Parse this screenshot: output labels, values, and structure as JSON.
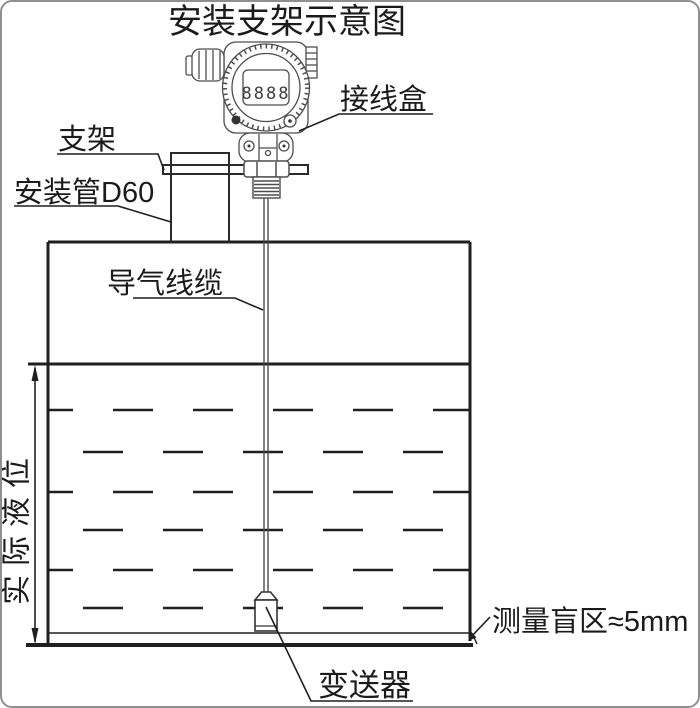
{
  "title": "安装支架示意图",
  "labels": {
    "junction_box": "接线盒",
    "bracket": "支架",
    "mounting_pipe": "安装管D60",
    "air_cable": "导气线缆",
    "actual_level": "实际液位",
    "blind_zone": "测量盲区≈5mm",
    "transmitter": "变送器"
  },
  "display": {
    "value": "8888"
  },
  "colors": {
    "main_line": "#1f1f1f",
    "detail_line": "#4d4d4d",
    "background": "#ffffff",
    "frame": "#8f8f8f"
  }
}
